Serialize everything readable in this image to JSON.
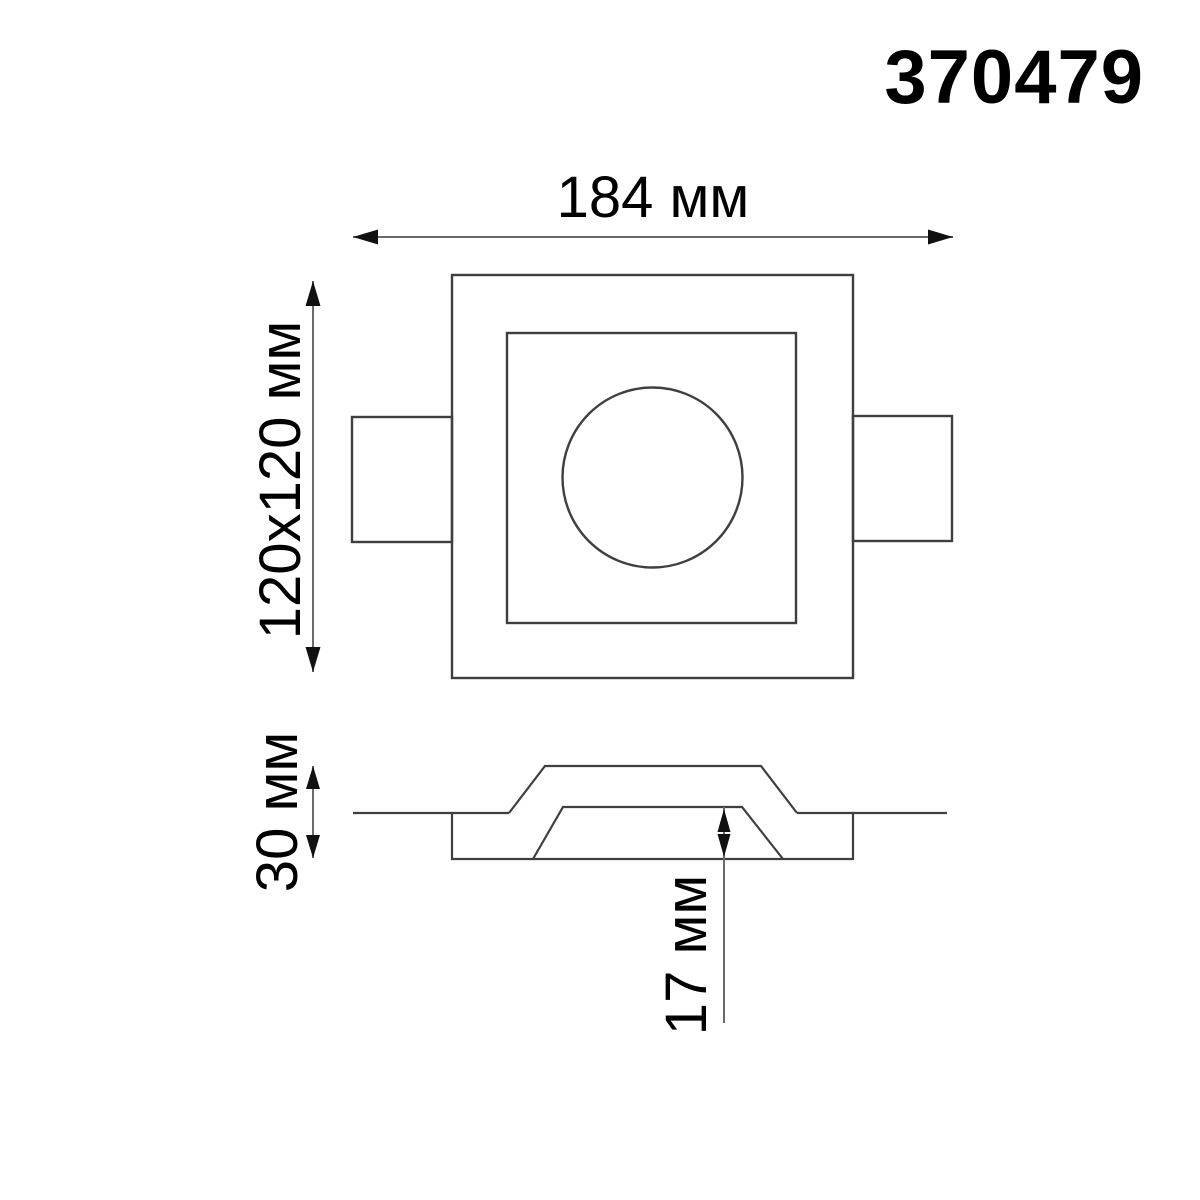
{
  "product": {
    "code": "370479"
  },
  "dimensions": {
    "overall_width": "184 мм",
    "face_size": "120x120 мм",
    "body_height": "30 мм",
    "recess_depth": "17 мм"
  },
  "colors": {
    "background": "#ffffff",
    "line": "#3f3f3f",
    "shaft": "#6b6b6b",
    "arrow": "#111111",
    "text": "#000000"
  }
}
